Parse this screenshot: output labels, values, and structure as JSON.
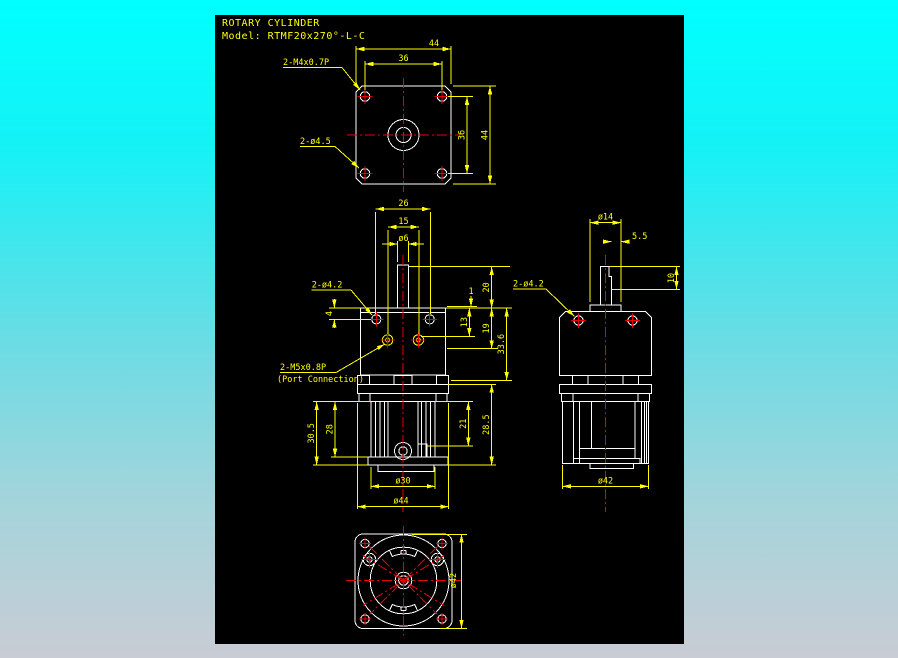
{
  "title": {
    "product": "ROTARY CYLINDER",
    "model": "Model: RTMF20x270°-L-C"
  },
  "colors": {
    "background_top": "#00ffff",
    "background_bottom": "#c9ccd4",
    "canvas": "#000000",
    "geometry": "#ffffff",
    "dimension": "#ffff00",
    "centerline": "#e80000"
  },
  "top_view": {
    "labels": {
      "tap_holes": "2-M4x0.7P",
      "drill_holes": "2-ø4.5"
    },
    "dims": {
      "width": "44",
      "bolt_span_h": "36",
      "bolt_span_v": "36",
      "height": "44"
    }
  },
  "front_view": {
    "labels": {
      "drill_holes": "2-ø4.2",
      "port_thread": "2-M5x0.8P",
      "port_note": "(Port Connection)"
    },
    "dims": {
      "hole_span": "26",
      "port_span": "15",
      "shaft_dia": "ø6",
      "plate_step": "1",
      "shaft_height": "20",
      "bore_depth": "13",
      "body_height": "19",
      "upper_height": "33.6",
      "hole_offset": "4",
      "lower_height": "30.5",
      "fin_height": "28",
      "cylinder_height": "21",
      "lower_total": "28.5",
      "base_dia": "ø30",
      "flange_dia": "ø44"
    }
  },
  "side_view": {
    "labels": {
      "drill_holes": "2-ø4.2"
    },
    "dims": {
      "hub_dia": "ø14",
      "step": "5.5",
      "thread_len": "10",
      "body_dia": "ø42"
    }
  },
  "bottom_view": {
    "dims": {
      "body_dia": "ø42"
    }
  }
}
